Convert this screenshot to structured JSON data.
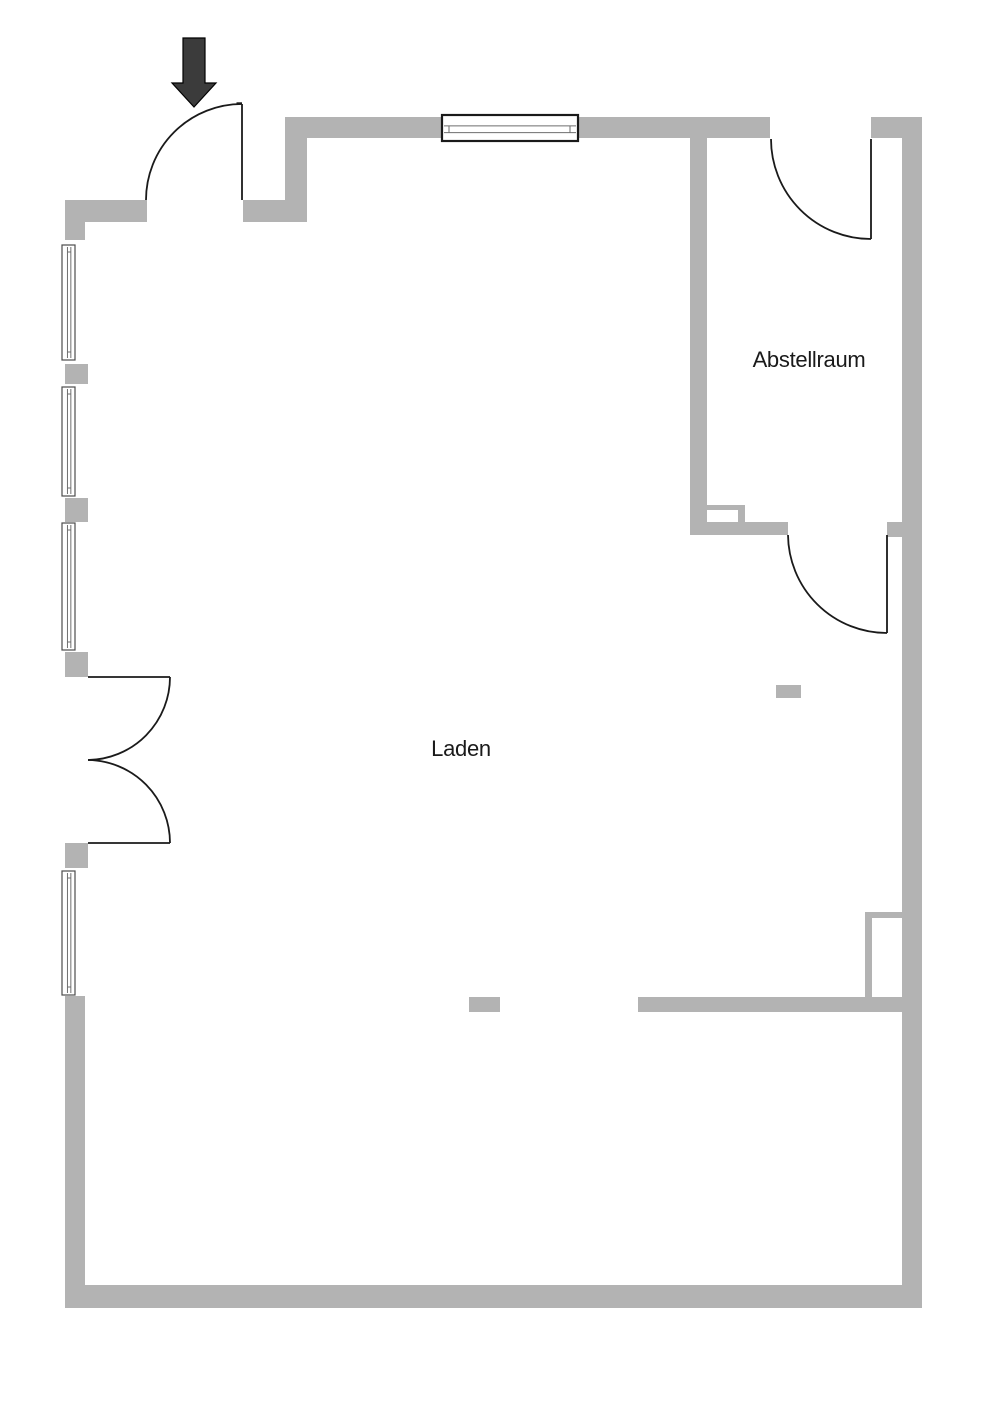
{
  "page": {
    "type": "floor-plan",
    "background": "#ffffff"
  },
  "colors": {
    "wall": "#b3b3b3",
    "door_line": "#1a1a1a",
    "arrow_fill": "#3b3b3b",
    "arrow_outline": "#000000",
    "window_frame_dark": "#1a1a1a",
    "window_frame_light": "#4d4d4d",
    "window_line": "#6e6e6e",
    "label_text": "#1a1a1a"
  },
  "rooms": [
    {
      "name": "laden",
      "label": "Laden",
      "cx": 461,
      "baseline_y": 756,
      "font_size": 22
    },
    {
      "name": "abstellraum",
      "label": "Abstellraum",
      "cx": 809,
      "baseline_y": 367,
      "font_size": 22
    }
  ],
  "floorplan": {
    "canvas": {
      "w": 1000,
      "h": 1415
    },
    "walls": [
      {
        "name": "wall-top-left",
        "x": 65,
        "y": 200,
        "w": 82,
        "h": 22
      },
      {
        "name": "wall-entry-right",
        "x": 243,
        "y": 200,
        "w": 64,
        "h": 22
      },
      {
        "name": "wall-entry-connector",
        "x": 285,
        "y": 117,
        "w": 22,
        "h": 105
      },
      {
        "name": "wall-top",
        "x": 285,
        "y": 117,
        "w": 485,
        "h": 21
      },
      {
        "name": "wall-top-right",
        "x": 871,
        "y": 117,
        "w": 51,
        "h": 21
      },
      {
        "name": "wall-right",
        "x": 902,
        "y": 117,
        "w": 20,
        "h": 1191
      },
      {
        "name": "wall-bottom",
        "x": 65,
        "y": 1285,
        "w": 857,
        "h": 23
      },
      {
        "name": "wall-left-lower",
        "x": 65,
        "y": 996,
        "w": 20,
        "h": 289
      },
      {
        "name": "wall-pier-1",
        "x": 65,
        "y": 222,
        "w": 20,
        "h": 18
      },
      {
        "name": "wall-pier-2",
        "x": 65,
        "y": 364,
        "w": 23,
        "h": 20
      },
      {
        "name": "wall-pier-3",
        "x": 65,
        "y": 498,
        "w": 23,
        "h": 24
      },
      {
        "name": "wall-pier-4",
        "x": 65,
        "y": 652,
        "w": 23,
        "h": 25
      },
      {
        "name": "wall-pier-5",
        "x": 65,
        "y": 843,
        "w": 23,
        "h": 25
      },
      {
        "name": "wall-abstellraum-left",
        "x": 690,
        "y": 138,
        "w": 17,
        "h": 397
      },
      {
        "name": "wall-abstellraum-bottom",
        "x": 690,
        "y": 522,
        "w": 98,
        "h": 13
      },
      {
        "name": "wall-hatch-top",
        "x": 707,
        "y": 505,
        "w": 38,
        "h": 5
      },
      {
        "name": "wall-hatch-right",
        "x": 738,
        "y": 510,
        "w": 7,
        "h": 12
      },
      {
        "name": "wall-door-stub",
        "x": 887,
        "y": 522,
        "w": 15,
        "h": 15
      },
      {
        "name": "wall-interior-lower",
        "x": 638,
        "y": 997,
        "w": 264,
        "h": 15
      },
      {
        "name": "wall-niche-left",
        "x": 865,
        "y": 912,
        "w": 7,
        "h": 98
      },
      {
        "name": "wall-niche-top",
        "x": 865,
        "y": 912,
        "w": 37,
        "h": 6
      },
      {
        "name": "column-shop",
        "x": 469,
        "y": 997,
        "w": 31,
        "h": 15
      },
      {
        "name": "column-right",
        "x": 776,
        "y": 685,
        "w": 25,
        "h": 13
      }
    ],
    "doors": [
      {
        "name": "door-entrance",
        "paths": [
          "M 242 104 L 242 200",
          "M 242 104 A 96 96 0 0 0 146 200",
          "M 236.5 103.2 L 242 103.2"
        ]
      },
      {
        "name": "door-abstellraum-top",
        "paths": [
          "M 871 139 L 871 239",
          "M 771 139 A 100 100 0 0 0 871 239"
        ]
      },
      {
        "name": "door-abstellraum-bottom",
        "paths": [
          "M 887 535 L 887 633",
          "M 788 535 A 99 99 0 0 0 887 633"
        ]
      },
      {
        "name": "door-double-upper-leaf",
        "paths": [
          "M 88 677 L 170 677",
          "M 170 677 A 83 83 0 0 1 88 760"
        ]
      },
      {
        "name": "door-double-lower-leaf",
        "paths": [
          "M 88 843 L 170 843",
          "M 88 760 A 83 83 0 0 1 170 843"
        ]
      }
    ],
    "windows": [
      {
        "name": "window-top",
        "x": 442,
        "y": 115,
        "w": 136,
        "h": 26,
        "orient": "h",
        "frame": "dark"
      },
      {
        "name": "window-left-1",
        "x": 62,
        "y": 245,
        "w": 13,
        "h": 115,
        "orient": "v",
        "frame": "light"
      },
      {
        "name": "window-left-2",
        "x": 62,
        "y": 387,
        "w": 13,
        "h": 109,
        "orient": "v",
        "frame": "light"
      },
      {
        "name": "window-left-3",
        "x": 62,
        "y": 523,
        "w": 13,
        "h": 127,
        "orient": "v",
        "frame": "light"
      },
      {
        "name": "window-left-4",
        "x": 62,
        "y": 871,
        "w": 13,
        "h": 124,
        "orient": "v",
        "frame": "light"
      }
    ],
    "arrow": {
      "name": "entrance-arrow",
      "points": "194,107 172,83 183,83 183,38 205,38 205,83 216,83"
    }
  }
}
